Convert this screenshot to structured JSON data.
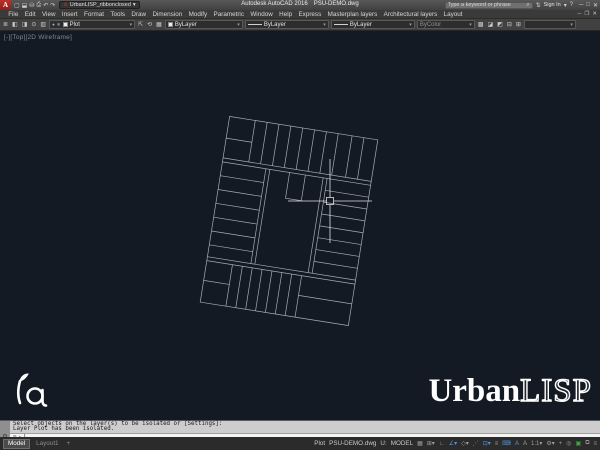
{
  "colors": {
    "canvas_bg": "#141a23",
    "line": "#a4acb4",
    "crosshair": "#dfe3e7",
    "toggle_on": "#4f97e8",
    "toggle_green": "#3aa845",
    "autocad_red": "#c2302a"
  },
  "title_bar": {
    "logo_letter": "A",
    "qat": [
      {
        "name": "new-icon",
        "glyph": "▢"
      },
      {
        "name": "open-icon",
        "glyph": "⬓"
      },
      {
        "name": "save-icon",
        "glyph": "⛁"
      },
      {
        "name": "plot-icon",
        "glyph": "⎙"
      },
      {
        "name": "undo-icon",
        "glyph": "↶"
      },
      {
        "name": "redo-icon",
        "glyph": "↷"
      }
    ],
    "workspace_gear": "⚙",
    "workspace_label": "UrbanLISP_ribbonclosed",
    "workspace_caret": "▾",
    "app_name": "Autodesk AutoCAD 2016",
    "doc_name": "PSU-DEMO.dwg",
    "search_placeholder": "Type a keyword or phrase",
    "search_icon": "⌕",
    "exchange_icon": "⇅",
    "sign_in_label": "Sign In",
    "sign_in_caret": "▾",
    "help_icon": "?",
    "win": {
      "min": "─",
      "max": "□",
      "close": "✕"
    }
  },
  "menu_bar": {
    "items": [
      "File",
      "Edit",
      "View",
      "Insert",
      "Format",
      "Tools",
      "Draw",
      "Dimension",
      "Modify",
      "Parametric",
      "Window",
      "Help",
      "Express",
      "Masterplan layers",
      "Architectural layers",
      "Layout"
    ],
    "win": {
      "min": "─",
      "restore": "❐",
      "close": "✕"
    }
  },
  "toolbar": {
    "layers_panel_icon": "≣",
    "left_icons": [
      {
        "name": "layer-isolate-icon",
        "glyph": "◧"
      },
      {
        "name": "layer-unisolate-icon",
        "glyph": "◨"
      },
      {
        "name": "layer-freeze-icon",
        "glyph": "⊙"
      },
      {
        "name": "layer-off-icon",
        "glyph": "▥"
      }
    ],
    "layer_field": {
      "bulb": "●",
      "freeze": "❄",
      "value": "Plot",
      "caret": "▾",
      "swatch": "#ececec"
    },
    "mid_icons": [
      {
        "name": "make-current-icon",
        "glyph": "⇱"
      },
      {
        "name": "layer-previous-icon",
        "glyph": "⟲"
      },
      {
        "name": "layer-states-icon",
        "glyph": "▦"
      }
    ],
    "color_field": {
      "value": "ByLayer",
      "caret": "▾",
      "swatch": "#ececec"
    },
    "linetype_field": {
      "value": "ByLayer",
      "caret": "▾"
    },
    "lineweight_field": {
      "value": "ByLayer",
      "caret": "▾"
    },
    "plotstyle_field": {
      "value": "ByColor",
      "caret": "▾"
    },
    "right_icons": [
      {
        "name": "match-properties-icon",
        "glyph": "▩"
      },
      {
        "name": "properties-a-icon",
        "glyph": "◪"
      },
      {
        "name": "properties-b-icon",
        "glyph": "◩"
      },
      {
        "name": "properties-c-icon",
        "glyph": "⊟"
      },
      {
        "name": "properties-d-icon",
        "glyph": "⊞"
      }
    ],
    "text_style_field": {
      "value": "",
      "caret": "▾"
    }
  },
  "viewport": {
    "controls_label": "[-][Top][2D Wireframe]"
  },
  "brand": {
    "right_solid": "Urban",
    "right_outline": "LISP"
  },
  "command_line": {
    "customize_icon": "⚙",
    "history": [
      "Select objects on the layer(s) to be isolated or [Settings]:",
      "Layer Plot has been isolated."
    ],
    "input": {
      "keyboard_icon": "⌨",
      "caret": "▾",
      "cursor": "|",
      "value": ""
    }
  },
  "status_bar": {
    "model_tab": "Model",
    "layout_tab": "Layout1",
    "add_layout": "+",
    "layer_label": "Plot",
    "file_label": "PSU-DEMO.dwg",
    "ucs_label": "U:",
    "space_label": "MODEL",
    "icons": [
      {
        "name": "grid-icon",
        "glyph": "▦",
        "state": "off"
      },
      {
        "name": "snap-icon",
        "glyph": "⊞▾",
        "state": "off"
      },
      {
        "name": "ortho-icon",
        "glyph": "∟",
        "state": "off"
      },
      {
        "name": "polar-tracking-icon",
        "glyph": "∠▾",
        "state": "on"
      },
      {
        "name": "isodraft-icon",
        "glyph": "◇▾",
        "state": "off"
      },
      {
        "name": "object-snap-tracking-icon",
        "glyph": "⋰",
        "state": "on"
      },
      {
        "name": "object-snap-icon",
        "glyph": "⊡▾",
        "state": "on"
      },
      {
        "name": "lineweight-icon",
        "glyph": "≡",
        "state": "off"
      },
      {
        "name": "dynamic-input-icon",
        "glyph": "⌨",
        "state": "on"
      },
      {
        "name": "annotation-visibility-icon",
        "glyph": "A",
        "state": "on"
      },
      {
        "name": "autoscale-icon",
        "glyph": "A",
        "state": "off"
      },
      {
        "name": "annotation-scale-label",
        "glyph": "1:1▾",
        "state": "off"
      },
      {
        "name": "workspace-gear-icon",
        "glyph": "⚙▾",
        "state": "off"
      },
      {
        "name": "annotation-monitor-icon",
        "glyph": "+",
        "state": "off"
      },
      {
        "name": "isolate-objects-icon",
        "glyph": "◎",
        "state": "off"
      },
      {
        "name": "graphics-performance-icon",
        "glyph": "▣",
        "state": "green"
      },
      {
        "name": "clean-screen-icon",
        "glyph": "⧉",
        "state": "off"
      },
      {
        "name": "customization-icon",
        "glyph": "≡",
        "state": "off"
      }
    ]
  }
}
